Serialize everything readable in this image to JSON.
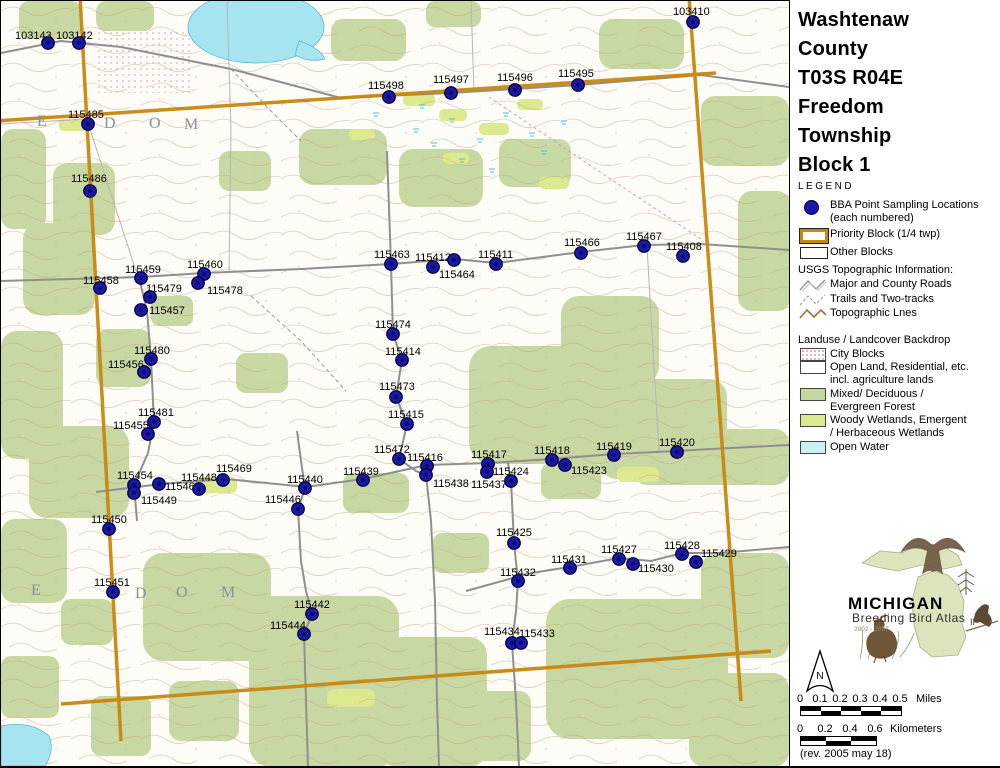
{
  "colors": {
    "bba_point": "#1A18A8",
    "priority_block": "#C8870E",
    "forest": "#C5D79E",
    "wetland": "#DDE98E",
    "open_water": "#C9F0F5",
    "city_blocks": "#E39AA6",
    "road": "#8F8F8F"
  },
  "panel": {
    "title_lines": [
      "Washtenaw",
      "County",
      "T03S R04E",
      "Freedom",
      "Township",
      "Block 1"
    ],
    "legend_label": "LEGEND",
    "legend_items": [
      {
        "symbol": "bba-dot",
        "label_lines": [
          "BBA Point Sampling Locations",
          "(each numbered)"
        ]
      },
      {
        "symbol": "priority-rect",
        "label_lines": [
          "Priority Block (1/4 twp)"
        ]
      },
      {
        "symbol": "other-rect",
        "label_lines": [
          "Other Blocks"
        ]
      }
    ],
    "usgs_header": "USGS Topographic Information:",
    "usgs_items": [
      {
        "symbol": "road-line",
        "label": "Major and County Roads"
      },
      {
        "symbol": "trail-line",
        "label": "Trails and Two-tracks"
      },
      {
        "symbol": "topo-line",
        "label": "Topographic Lnes"
      }
    ],
    "landuse_header": "Landuse / Landcover Backdrop",
    "landuse_items": [
      {
        "color": "#E39AA6",
        "label_lines": [
          "City Blocks"
        ]
      },
      {
        "color": "#FFFFFF",
        "label_lines": [
          "Open Land, Residential, etc.",
          "incl. agriculture lands"
        ]
      },
      {
        "color": "#C5D79E",
        "label_lines": [
          "Mixed/ Deciduous /",
          "Evergreen Forest"
        ]
      },
      {
        "color": "#DDE98E",
        "label_lines": [
          "Woody Wetlands, Emergent",
          "/ Herbaceous Wetlands"
        ]
      },
      {
        "color": "#C9F0F5",
        "label_lines": [
          "Open Water"
        ]
      }
    ],
    "logo": {
      "state_name": "MICHIGAN",
      "line2": "Breeding Bird Atlas",
      "years": "2002 - 2007",
      "numeral": "II"
    },
    "north_label": "N",
    "scale_miles": {
      "ticks": [
        "0",
        "0.1",
        "0.2",
        "0.3",
        "0.4",
        "0.5"
      ],
      "unit": "Miles"
    },
    "scale_km": {
      "ticks": [
        "0",
        "0.2",
        "0.4",
        "0.6"
      ],
      "unit": "Kilometers"
    },
    "revision": "(rev. 2005 may 18)"
  },
  "map": {
    "township_letters": [
      {
        "ch": "E",
        "x": 36,
        "y": 112
      },
      {
        "ch": "D",
        "x": 103,
        "y": 114
      },
      {
        "ch": "O",
        "x": 148,
        "y": 114
      },
      {
        "ch": "M",
        "x": 183,
        "y": 115
      },
      {
        "ch": "E",
        "x": 30,
        "y": 581
      },
      {
        "ch": "E",
        "x": 106,
        "y": 583
      },
      {
        "ch": "D",
        "x": 134,
        "y": 584
      },
      {
        "ch": "O",
        "x": 175,
        "y": 583
      },
      {
        "ch": "M",
        "x": 220,
        "y": 583
      }
    ],
    "points": [
      {
        "id": "103143",
        "x": 47,
        "y": 42,
        "lx": 14,
        "ly": 29
      },
      {
        "id": "103142",
        "x": 78,
        "y": 42,
        "lx": 55,
        "ly": 29
      },
      {
        "id": "103410",
        "x": 692,
        "y": 21,
        "lx": 672,
        "ly": 5
      },
      {
        "id": "115485",
        "x": 87,
        "y": 123,
        "lx": 67,
        "ly": 108
      },
      {
        "id": "115486",
        "x": 89,
        "y": 190,
        "lx": 70,
        "ly": 172
      },
      {
        "id": "115498",
        "x": 388,
        "y": 96,
        "lx": 367,
        "ly": 79
      },
      {
        "id": "115497",
        "x": 450,
        "y": 92,
        "lx": 432,
        "ly": 73
      },
      {
        "id": "115496",
        "x": 514,
        "y": 89,
        "lx": 496,
        "ly": 71
      },
      {
        "id": "115495",
        "x": 577,
        "y": 84,
        "lx": 557,
        "ly": 67
      },
      {
        "id": "115458",
        "x": 99,
        "y": 287,
        "lx": 82,
        "ly": 274
      },
      {
        "id": "115459",
        "x": 140,
        "y": 277,
        "lx": 124,
        "ly": 263
      },
      {
        "id": "115460",
        "x": 203,
        "y": 273,
        "lx": 186,
        "ly": 258
      },
      {
        "id": "115478",
        "x": 197,
        "y": 282,
        "lx": 206,
        "ly": 284
      },
      {
        "id": "115479",
        "x": 149,
        "y": 296,
        "lx": 145,
        "ly": 282
      },
      {
        "id": "115457",
        "x": 140,
        "y": 309,
        "lx": 148,
        "ly": 304
      },
      {
        "id": "115480",
        "x": 150,
        "y": 358,
        "lx": 133,
        "ly": 344
      },
      {
        "id": "115456",
        "x": 143,
        "y": 371,
        "lx": 107,
        "ly": 358
      },
      {
        "id": "115481",
        "x": 153,
        "y": 421,
        "lx": 137,
        "ly": 406
      },
      {
        "id": "115455",
        "x": 147,
        "y": 433,
        "lx": 112,
        "ly": 419
      },
      {
        "id": "115463",
        "x": 390,
        "y": 263,
        "lx": 373,
        "ly": 248
      },
      {
        "id": "115412",
        "x": 453,
        "y": 259,
        "lx": 414,
        "ly": 251
      },
      {
        "id": "115464",
        "x": 432,
        "y": 266,
        "lx": 438,
        "ly": 268
      },
      {
        "id": "115411",
        "x": 495,
        "y": 263,
        "lx": 477,
        "ly": 248
      },
      {
        "id": "115466",
        "x": 580,
        "y": 252,
        "lx": 563,
        "ly": 236
      },
      {
        "id": "115467",
        "x": 643,
        "y": 245,
        "lx": 625,
        "ly": 230
      },
      {
        "id": "115408",
        "x": 682,
        "y": 255,
        "lx": 665,
        "ly": 240
      },
      {
        "id": "115474",
        "x": 392,
        "y": 333,
        "lx": 374,
        "ly": 318
      },
      {
        "id": "115414",
        "x": 401,
        "y": 359,
        "lx": 384,
        "ly": 345
      },
      {
        "id": "115473",
        "x": 395,
        "y": 396,
        "lx": 378,
        "ly": 380
      },
      {
        "id": "115415",
        "x": 406,
        "y": 423,
        "lx": 387,
        "ly": 408
      },
      {
        "id": "115472",
        "x": 398,
        "y": 458,
        "lx": 373,
        "ly": 443
      },
      {
        "id": "115416",
        "x": 426,
        "y": 465,
        "lx": 406,
        "ly": 451
      },
      {
        "id": "115438",
        "x": 425,
        "y": 474,
        "lx": 432,
        "ly": 477
      },
      {
        "id": "115439",
        "x": 362,
        "y": 479,
        "lx": 342,
        "ly": 465
      },
      {
        "id": "115417",
        "x": 487,
        "y": 463,
        "lx": 470,
        "ly": 448
      },
      {
        "id": "115437",
        "x": 486,
        "y": 471,
        "lx": 470,
        "ly": 478
      },
      {
        "id": "115424",
        "x": 510,
        "y": 480,
        "lx": 492,
        "ly": 465
      },
      {
        "id": "115418",
        "x": 551,
        "y": 459,
        "lx": 533,
        "ly": 444
      },
      {
        "id": "115423",
        "x": 564,
        "y": 464,
        "lx": 570,
        "ly": 464
      },
      {
        "id": "115419",
        "x": 613,
        "y": 454,
        "lx": 595,
        "ly": 440
      },
      {
        "id": "115420",
        "x": 676,
        "y": 451,
        "lx": 658,
        "ly": 436
      },
      {
        "id": "115454",
        "x": 133,
        "y": 484,
        "lx": 116,
        "ly": 469
      },
      {
        "id": "115449",
        "x": 133,
        "y": 492,
        "lx": 140,
        "ly": 494
      },
      {
        "id": "115448",
        "x": 158,
        "y": 483,
        "lx": 180,
        "ly": 471
      },
      {
        "id": "115468",
        "x": 198,
        "y": 488,
        "lx": 164,
        "ly": 480
      },
      {
        "id": "115469",
        "x": 222,
        "y": 479,
        "lx": 215,
        "ly": 462
      },
      {
        "id": "115440",
        "x": 304,
        "y": 487,
        "lx": 286,
        "ly": 473
      },
      {
        "id": "115446",
        "x": 297,
        "y": 508,
        "lx": 264,
        "ly": 493
      },
      {
        "id": "115450",
        "x": 108,
        "y": 528,
        "lx": 90,
        "ly": 513
      },
      {
        "id": "115451",
        "x": 112,
        "y": 591,
        "lx": 93,
        "ly": 576
      },
      {
        "id": "115442",
        "x": 311,
        "y": 613,
        "lx": 293,
        "ly": 598
      },
      {
        "id": "115444",
        "x": 303,
        "y": 633,
        "lx": 269,
        "ly": 619
      },
      {
        "id": "115425",
        "x": 513,
        "y": 542,
        "lx": 495,
        "ly": 526
      },
      {
        "id": "115432",
        "x": 517,
        "y": 580,
        "lx": 499,
        "ly": 566
      },
      {
        "id": "115431",
        "x": 569,
        "y": 567,
        "lx": 550,
        "ly": 553
      },
      {
        "id": "115427",
        "x": 618,
        "y": 558,
        "lx": 600,
        "ly": 543
      },
      {
        "id": "115430",
        "x": 632,
        "y": 563,
        "lx": 637,
        "ly": 562
      },
      {
        "id": "115428",
        "x": 681,
        "y": 553,
        "lx": 663,
        "ly": 539
      },
      {
        "id": "115429",
        "x": 695,
        "y": 561,
        "lx": 700,
        "ly": 547
      },
      {
        "id": "115434",
        "x": 511,
        "y": 642,
        "lx": 483,
        "ly": 625
      },
      {
        "id": "115433",
        "x": 520,
        "y": 642,
        "lx": 518,
        "ly": 627
      }
    ]
  }
}
